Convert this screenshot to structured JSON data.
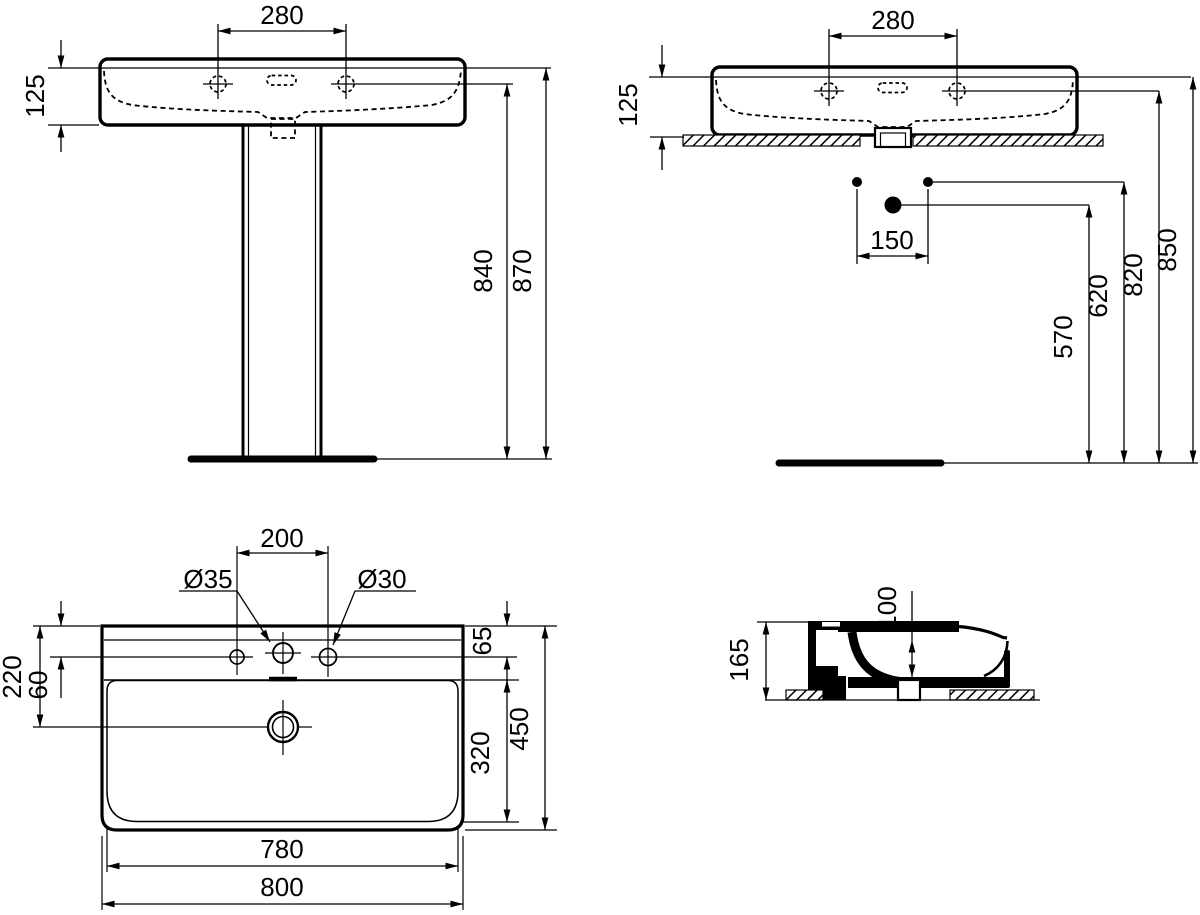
{
  "title": "Washbasin technical dimensional drawing",
  "colors": {
    "line": "#000000",
    "background": "#ffffff"
  },
  "views": {
    "front": {
      "label": "front view with pedestal",
      "dims": {
        "tap_spacing": "280",
        "rim_depth": "125",
        "tap_height": "840",
        "overall_height": "870"
      }
    },
    "side": {
      "label": "wall-hung front view with fixing points",
      "dims": {
        "tap_spacing": "280",
        "rim_depth": "125",
        "bolt_spacing": "150",
        "waste_height": "570",
        "bolt_height": "620",
        "tap_height": "820",
        "rim_height": "850"
      }
    },
    "plan": {
      "label": "plan view",
      "dims": {
        "side_hole_spacing": "200",
        "centre_hole_dia": "Ø35",
        "side_hole_dia": "Ø30",
        "waste_offset": "220",
        "tap_offset_left": "60",
        "tap_offset_right": "65",
        "bowl_length": "320",
        "overall_depth": "450",
        "bowl_width": "780",
        "overall_width": "800"
      }
    },
    "section": {
      "label": "cross section",
      "dims": {
        "bowl_depth": "100",
        "overall_height": "165"
      }
    }
  }
}
